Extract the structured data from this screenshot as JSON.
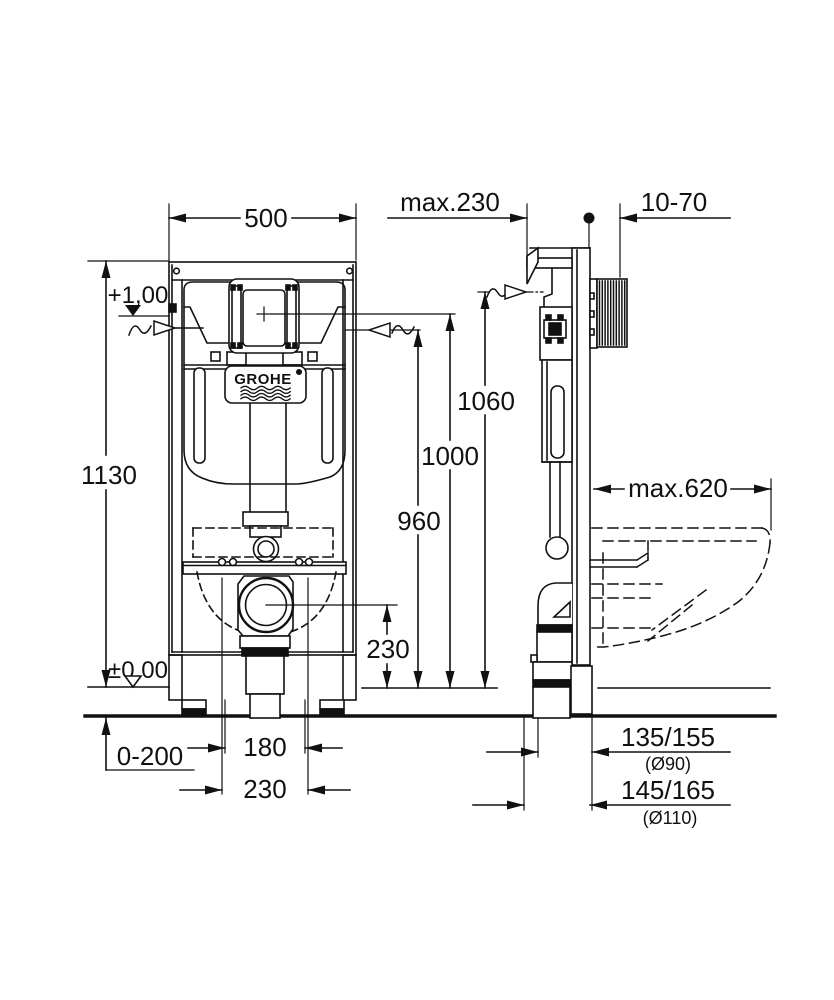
{
  "meta": {
    "drawing_type": "installation dimensional drawing",
    "background": "#ffffff",
    "line_color": "#111111"
  },
  "brand": {
    "logo_text": "GROHE"
  },
  "dims": {
    "front_width": "500",
    "frame_height": "1130",
    "level_top": "+1,00",
    "level_floor": "±0,00",
    "floor_buildup": "0-200",
    "outlet_gap_inner": "180",
    "outlet_gap_outer": "230",
    "height_flush_pipe": "1060",
    "height_plate_center": "1000",
    "height_water_supply": "960",
    "height_outlet_center": "230",
    "depth_max": "max.230",
    "wall_clearance": "10-70",
    "bowl_depth_max": "max.620",
    "outlet_offset_90": "135/155",
    "outlet_dia_90": "(Ø90)",
    "outlet_offset_110": "145/165",
    "outlet_dia_110": "(Ø110)"
  }
}
